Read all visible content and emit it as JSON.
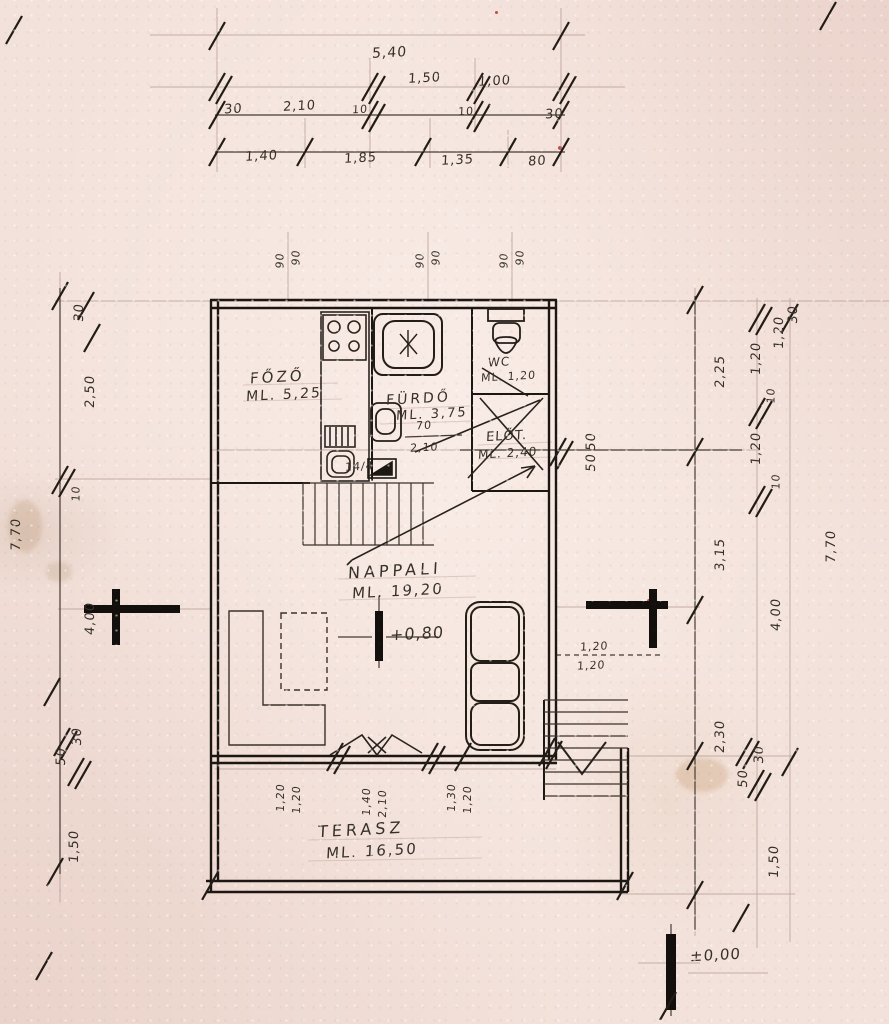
{
  "drawing": {
    "type": "floor-plan-sketch",
    "levels": {
      "upper": "+0,80",
      "ground": "±0,00"
    }
  },
  "rooms": {
    "fozo": {
      "name": "FŐZŐ",
      "area": "ML. 5,25"
    },
    "furdo": {
      "name": "FÜRDŐ",
      "area": "ML. 3,75"
    },
    "wc": {
      "name": "WC",
      "area": "ML. 1,20"
    },
    "elo": {
      "name": "ELŐT.",
      "area": "ML. 2,40"
    },
    "nappali": {
      "name": "NAPPALI",
      "area": "ML. 19,20"
    },
    "terasz": {
      "name": "TERASZ",
      "area": "ML. 16,50"
    }
  },
  "dims": {
    "t540": "5,40",
    "t150": "1,50",
    "t100": "1,00",
    "t30l": "30",
    "t210": "2,10",
    "t10a": "10",
    "t10b": "10",
    "t30r": "30",
    "t140": "1,40",
    "t185": "1,85",
    "t135": "1,35",
    "t80": "80",
    "w90a": "90",
    "w90b": "90",
    "w90c": "90",
    "w90d": "90",
    "w90e": "90",
    "w90f": "90",
    "l30": "30",
    "l250": "2,50",
    "l10": "10",
    "l770": "7,70",
    "l400": "4,00",
    "l50": "50",
    "l30b": "30",
    "l150": "1,50",
    "r120t": "1,20",
    "r30t": "30",
    "r225": "2,25",
    "r120a": "1,20",
    "r10a": "10",
    "r120b": "1,20",
    "r10b": "10",
    "r315": "3,15",
    "r770": "7,70",
    "r400": "4,00",
    "r230": "2,30",
    "r30b": "30",
    "r50": "50",
    "r150": "1,50",
    "m50a": "50",
    "m50b": "50",
    "sofa120a": "1,20",
    "sofa120b": "1,20",
    "i70": "70",
    "i210": "2,10",
    "i144": "14/4",
    "b120a": "1,20",
    "b120b": "1,20",
    "b140": "1,40",
    "b210": "2,10",
    "b130": "1,30",
    "b120c": "1,20"
  }
}
